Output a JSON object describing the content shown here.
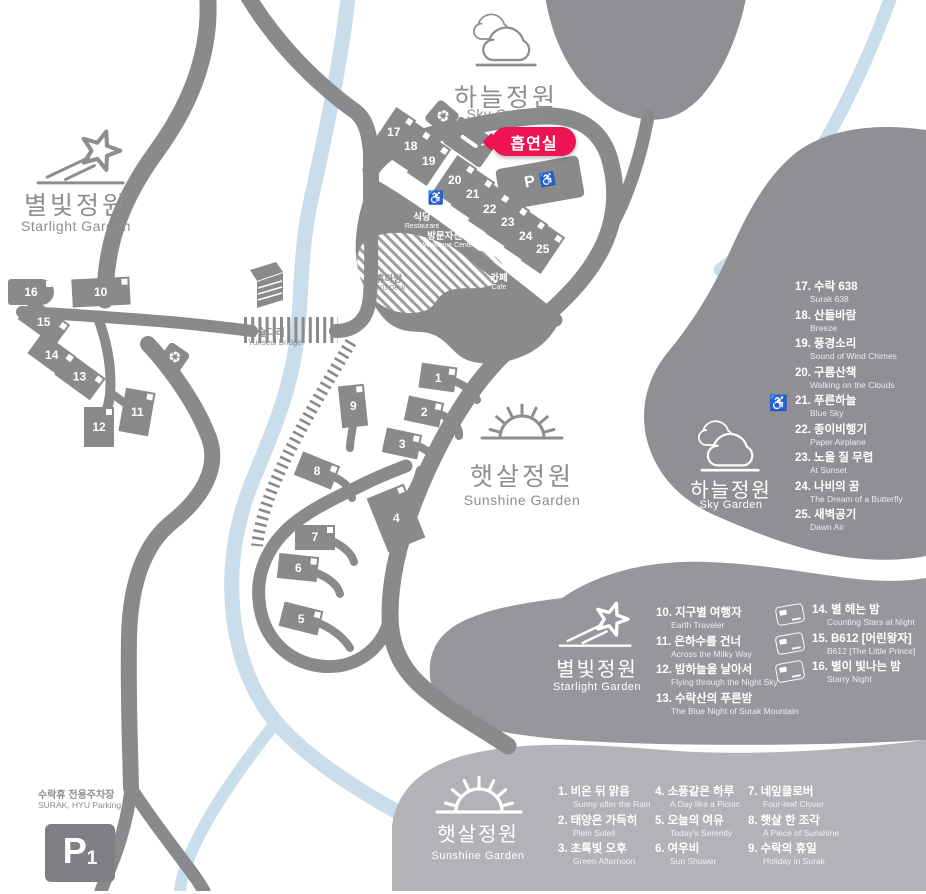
{
  "colors": {
    "road": "#898a8c",
    "blob_dark": "#8f9093",
    "blob_mid": "#96979a",
    "blob_light": "#b2b3b6",
    "river": "#c9ddeb",
    "badge": "#ee1452",
    "label_gray": "#8d8e90"
  },
  "icons": {
    "recycle": "♻",
    "wheelchair": "♿"
  },
  "map": {
    "regions": {
      "sky": {
        "title": "하늘정원",
        "subtitle": "Sky Garden"
      },
      "starlight": {
        "title": "별빛정원",
        "subtitle": "Starlight Garden"
      },
      "sunshine": {
        "title": "햇살정원",
        "subtitle": "Sunshine Garden"
      }
    },
    "smoking_badge": "흡연실",
    "facilities": {
      "restaurant": {
        "ko": "식당",
        "en": "Restaurant"
      },
      "welcome_center": {
        "ko": "방문자센터",
        "en": "Welcome Center"
      },
      "hyu_deck": {
        "ko": "휴마당",
        "en": "HYU Deck"
      },
      "cafe": {
        "ko": "카페",
        "en": "Cafe"
      },
      "bridge": {
        "ko": "윤슬다리",
        "en": "Yunseul Bridge"
      }
    },
    "parking": {
      "label_ko": "수락휴 전용주차장",
      "label_en": "SURAK, HYU Parking Lot",
      "p1_letter": "P",
      "p1_number": "1",
      "p": "P"
    },
    "cabins": [
      {
        "no": 1,
        "x": 438,
        "y": 377,
        "rot": 8,
        "w": 36,
        "h": 25
      },
      {
        "no": 2,
        "x": 424,
        "y": 411,
        "rot": 12,
        "w": 36,
        "h": 25
      },
      {
        "no": 3,
        "x": 402,
        "y": 443,
        "rot": 12,
        "w": 36,
        "h": 25
      },
      {
        "no": 4,
        "x": 396,
        "y": 518,
        "rot": -22,
        "w": 40,
        "h": 58
      },
      {
        "no": 5,
        "x": 301,
        "y": 618,
        "rot": 14,
        "w": 40,
        "h": 25
      },
      {
        "no": 6,
        "x": 298,
        "y": 567,
        "rot": 6,
        "w": 40,
        "h": 25
      },
      {
        "no": 7,
        "x": 315,
        "y": 537,
        "rot": 0,
        "w": 40,
        "h": 25
      },
      {
        "no": 8,
        "x": 317,
        "y": 470,
        "rot": 22,
        "w": 40,
        "h": 25
      },
      {
        "no": 9,
        "x": 353,
        "y": 406,
        "rot": -6,
        "w": 26,
        "h": 42
      },
      {
        "no": 10,
        "x": 101,
        "y": 292,
        "rot": -3,
        "w": 58,
        "h": 28
      },
      {
        "no": 11,
        "x": 137,
        "y": 412,
        "rot": 10,
        "w": 30,
        "h": 44
      },
      {
        "no": 12,
        "x": 99,
        "y": 427,
        "rot": 0,
        "w": 30,
        "h": 40
      },
      {
        "no": 13,
        "x": 80,
        "y": 376,
        "rot": 36,
        "w": 44,
        "h": 27
      },
      {
        "no": 14,
        "x": 52,
        "y": 355,
        "rot": 36,
        "w": 42,
        "h": 26
      },
      {
        "no": 15,
        "x": 44,
        "y": 322,
        "rot": 36,
        "w": 46,
        "h": 26
      },
      {
        "no": 16,
        "x": 31,
        "y": 292,
        "rot": 0,
        "w": 46,
        "h": 26,
        "r": "3px 13px 13px 3px"
      },
      {
        "no": 17,
        "x": 394,
        "y": 132,
        "rot": 34,
        "w": 24,
        "h": 44
      },
      {
        "no": 18,
        "x": 411,
        "y": 146,
        "rot": 34,
        "w": 24,
        "h": 44
      },
      {
        "no": 19,
        "x": 429,
        "y": 161,
        "rot": 34,
        "w": 24,
        "h": 44
      },
      {
        "no": 20,
        "x": 455,
        "y": 180,
        "rot": 34,
        "w": 24,
        "h": 44
      },
      {
        "no": 21,
        "x": 473,
        "y": 194,
        "rot": 34,
        "w": 24,
        "h": 44
      },
      {
        "no": 22,
        "x": 490,
        "y": 209,
        "rot": 34,
        "w": 24,
        "h": 44
      },
      {
        "no": 23,
        "x": 508,
        "y": 222,
        "rot": 34,
        "w": 24,
        "h": 44
      },
      {
        "no": 24,
        "x": 526,
        "y": 236,
        "rot": 34,
        "w": 24,
        "h": 44
      },
      {
        "no": 25,
        "x": 543,
        "y": 249,
        "rot": 34,
        "w": 24,
        "h": 44
      }
    ]
  },
  "legend": {
    "sky": {
      "items": [
        {
          "no": 17,
          "ko": "수락 638",
          "en": "Surak 638"
        },
        {
          "no": 18,
          "ko": "산들바람",
          "en": "Breeze"
        },
        {
          "no": 19,
          "ko": "풍경소리",
          "en": "Sound of Wind Chimes"
        },
        {
          "no": 20,
          "ko": "구름산책",
          "en": "Walking on the Clouds"
        },
        {
          "no": 21,
          "ko": "푸른하늘",
          "en": "Blue Sky",
          "accessible": true
        },
        {
          "no": 22,
          "ko": "종이비행기",
          "en": "Paper Airplane"
        },
        {
          "no": 23,
          "ko": "노을 질 무렵",
          "en": "At Sunset"
        },
        {
          "no": 24,
          "ko": "나비의 꿈",
          "en": "The Dream of a Butterfly"
        },
        {
          "no": 25,
          "ko": "새벽공기",
          "en": "Dawn Air"
        }
      ]
    },
    "starlight": {
      "items_left": [
        {
          "no": 10,
          "ko": "지구별 여행자",
          "en": "Earth Traveler"
        },
        {
          "no": 11,
          "ko": "은하수를 건너",
          "en": "Across the Milky Way"
        },
        {
          "no": 12,
          "ko": "밤하늘을 날아서",
          "en": "Flying through the Night Sky"
        },
        {
          "no": 13,
          "ko": "수락산의 푸른밤",
          "en": "The Blue Night of Surak Mountain"
        }
      ],
      "items_right": [
        {
          "no": 14,
          "ko": "별 헤는 밤",
          "en": "Counting Stars at Night"
        },
        {
          "no": 15,
          "ko": "B612 [어린왕자]",
          "en": "B612 [The Little Prince]"
        },
        {
          "no": 16,
          "ko": "별이 빛나는 밤",
          "en": "Starry Night"
        }
      ]
    },
    "sunshine": {
      "col1": [
        {
          "no": 1,
          "ko": "비온 뒤 맑음",
          "en": "Sunny after the Rain"
        },
        {
          "no": 2,
          "ko": "태양은 가득히",
          "en": "Plein Soleil"
        },
        {
          "no": 3,
          "ko": "초록빛 오후",
          "en": "Green Afternoon"
        }
      ],
      "col2": [
        {
          "no": 4,
          "ko": "소풍같은 하루",
          "en": "A Day like a Picnic"
        },
        {
          "no": 5,
          "ko": "오늘의 여유",
          "en": "Today's Serenity"
        },
        {
          "no": 6,
          "ko": "여우비",
          "en": "Sun Shower"
        }
      ],
      "col3": [
        {
          "no": 7,
          "ko": "네잎클로버",
          "en": "Four-leaf Clover"
        },
        {
          "no": 8,
          "ko": "햇살 한 조각",
          "en": "A Piece of Sunshine"
        },
        {
          "no": 9,
          "ko": "수락의 휴일",
          "en": "Holiday in Surak"
        }
      ]
    }
  }
}
